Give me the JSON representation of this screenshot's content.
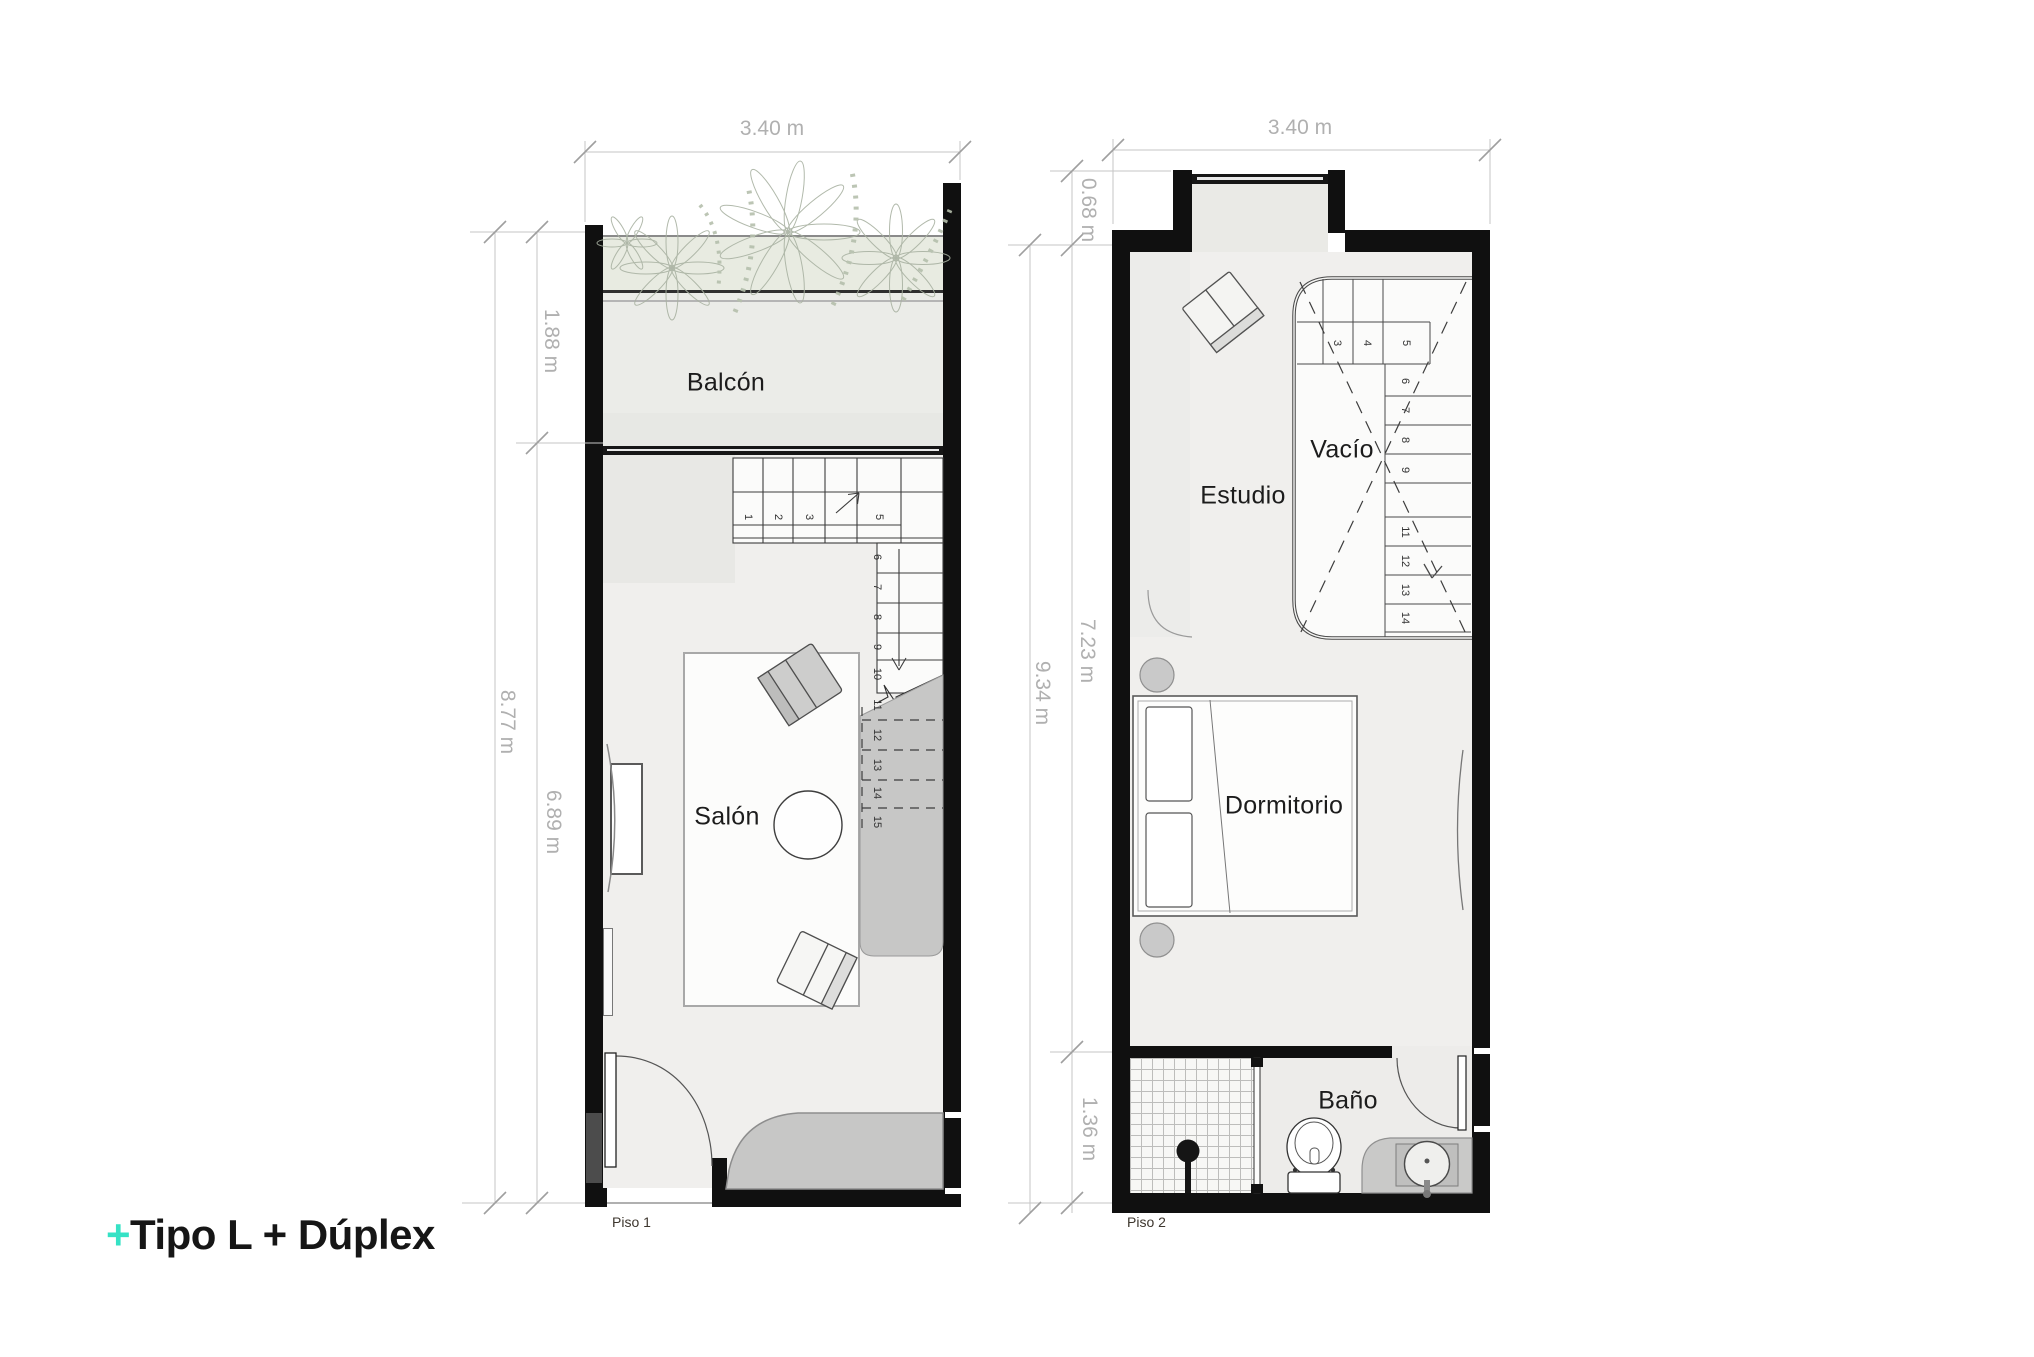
{
  "title": {
    "accent": "+",
    "text": "Tipo L + Dúplex"
  },
  "colors": {
    "accent": "#35e2c5",
    "wall": "#101010",
    "dim_text": "#b0b0b0"
  },
  "plans": {
    "p1": {
      "label": "Piso 1",
      "room_balcony": "Balcón",
      "room_living": "Salón",
      "dim_width": "3.40 m",
      "dim_balcony": "1.88 m",
      "dim_total": "8.77 m",
      "dim_living": "6.89 m",
      "stairs_top": [
        "1",
        "2",
        "3",
        "5"
      ],
      "stairs_side": [
        "6",
        "7",
        "8",
        "9",
        "10",
        "11",
        "12",
        "13",
        "14",
        "15"
      ]
    },
    "p2": {
      "label": "Piso 2",
      "room_study": "Estudio",
      "room_void": "Vacío",
      "room_bedroom": "Dormitorio",
      "room_bath": "Baño",
      "dim_width": "3.40 m",
      "dim_top": "0.68 m",
      "dim_total": "9.34 m",
      "dim_main": "7.23 m",
      "dim_bath": "1.36 m",
      "stairs_top": [
        "3",
        "4",
        "5"
      ],
      "stairs_side": [
        "6",
        "7",
        "8",
        "9",
        "11",
        "12",
        "13",
        "14"
      ]
    }
  }
}
